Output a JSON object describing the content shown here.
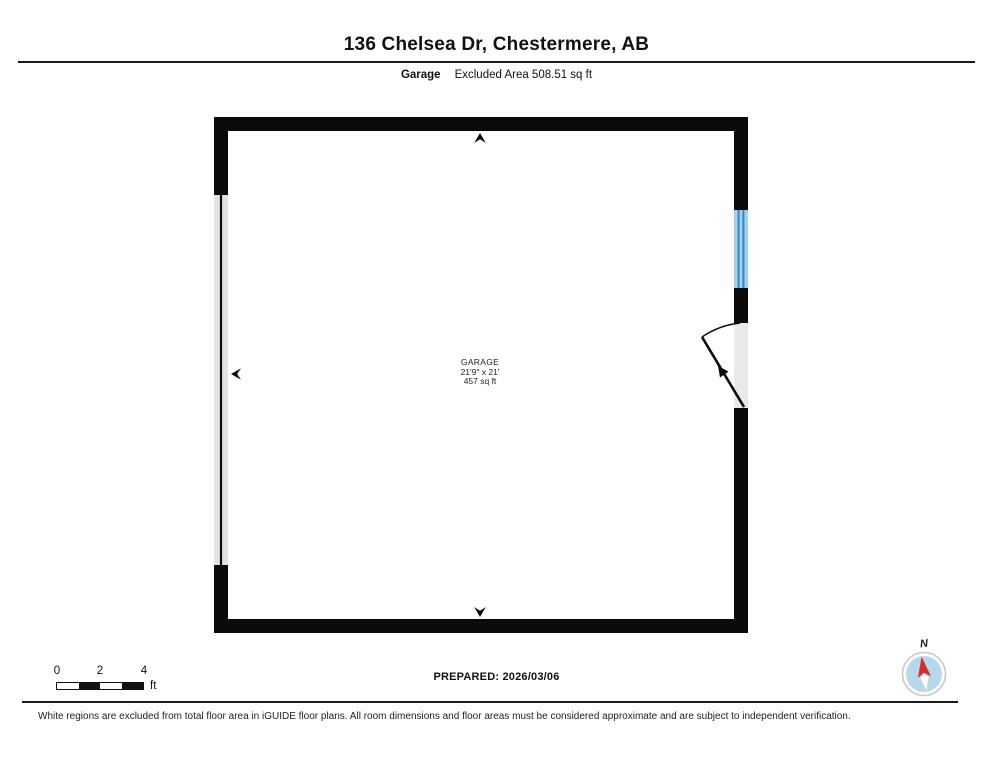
{
  "header": {
    "title": "136 Chelsea Dr, Chestermere, AB",
    "floor_label": "Garage",
    "area_label": "Excluded Area 508.51 sq ft"
  },
  "room": {
    "name": "GARAGE",
    "dimensions": "21'9\" x 21'",
    "area": "457 sq ft"
  },
  "scale_bar": {
    "ticks": [
      "0",
      "2",
      "4"
    ],
    "unit": "ft"
  },
  "footer": {
    "prepared": "PREPARED: 2026/03/06",
    "compass_label": "N",
    "disclaimer": "White regions are excluded from total floor area in iGUIDE floor plans. All room dimensions and floor areas must be considered approximate and are subject to independent verification."
  },
  "colors": {
    "wall": "#0b0b0b",
    "garage_door_fill": "#e3e3e3",
    "door_opening_fill": "#e9e9e9",
    "window_fill": "#9ed2ec",
    "window_stripe": "#3a82c4",
    "compass_fill": "#b5d8ea",
    "compass_needle_north": "#d92b2b"
  }
}
